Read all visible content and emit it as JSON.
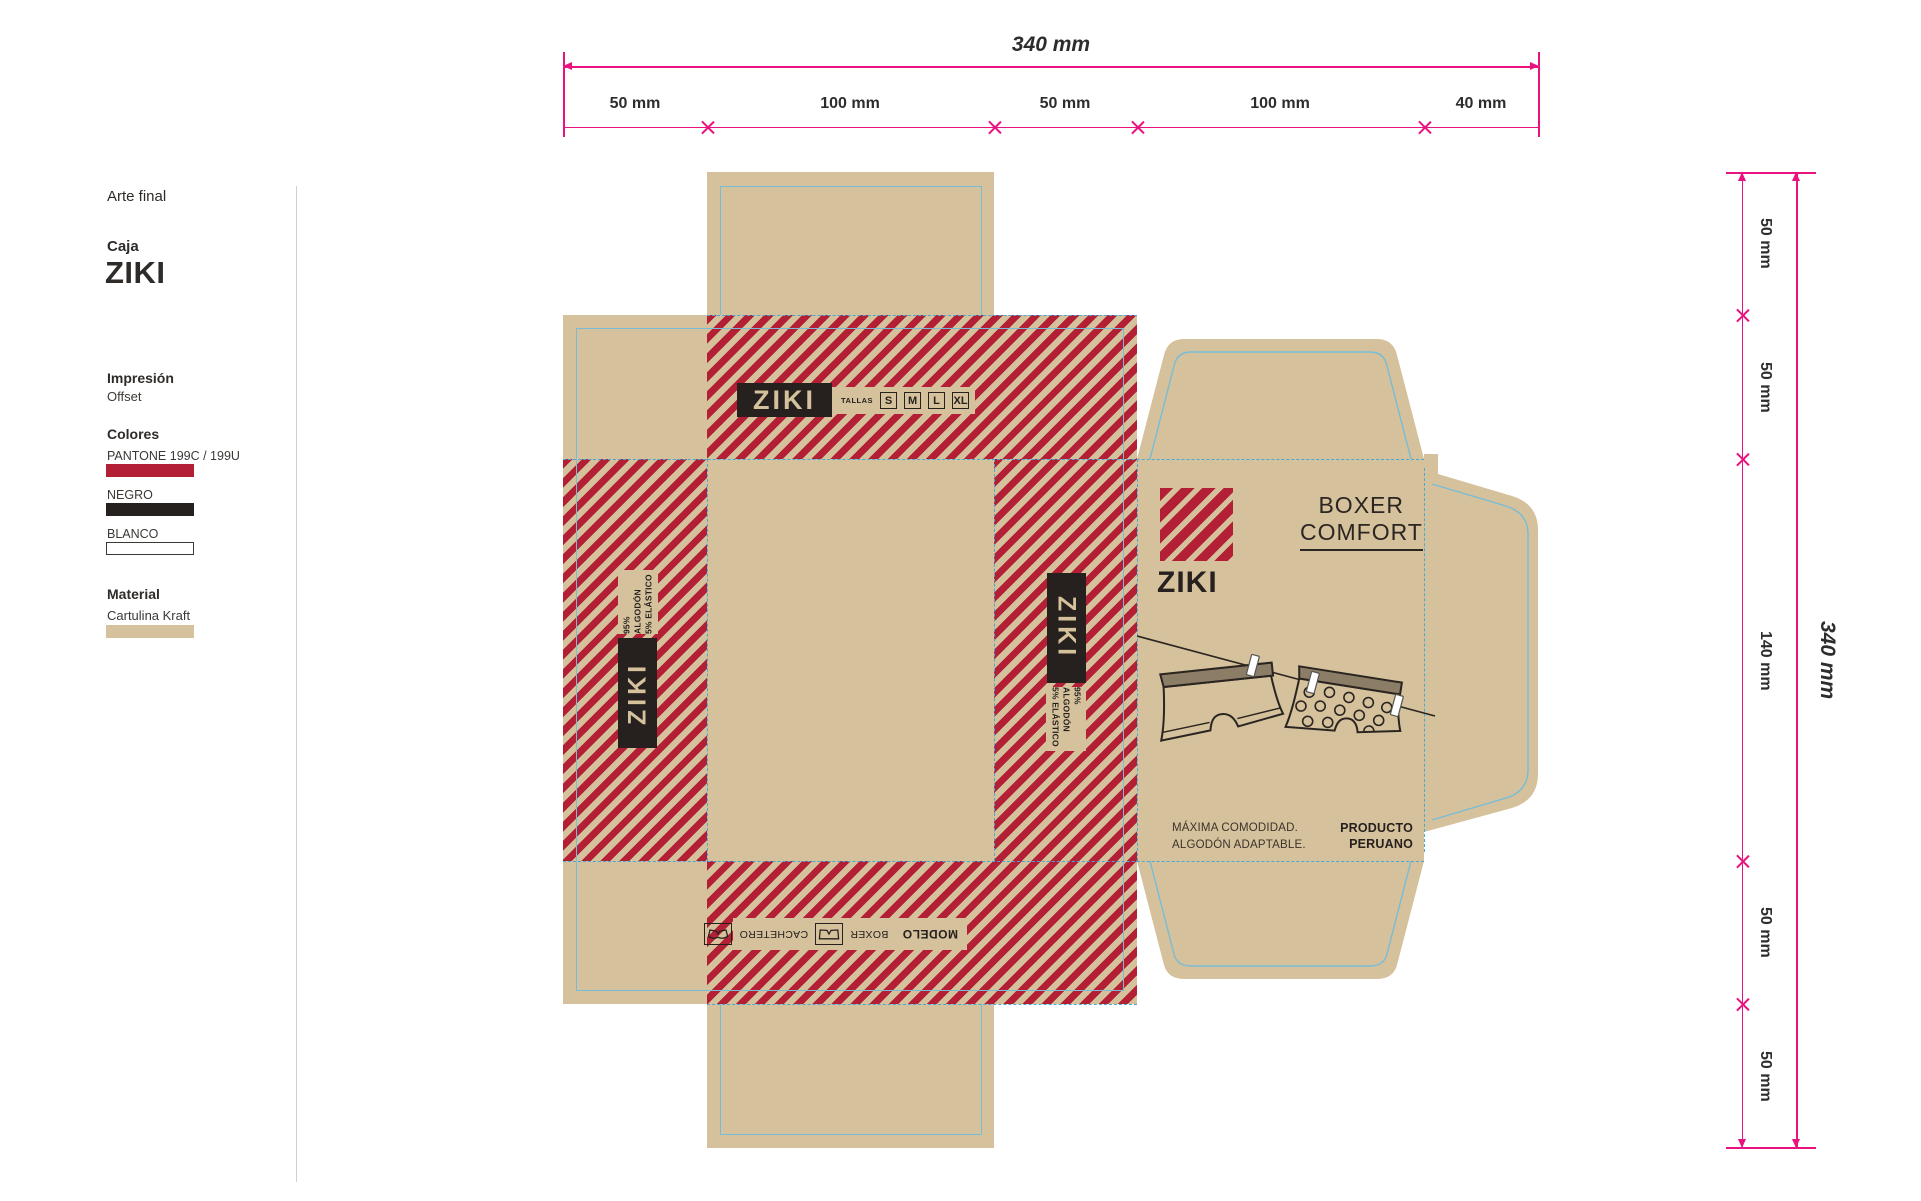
{
  "sidebar": {
    "title": "Arte final",
    "project_label": "Caja",
    "project_name": "ZIKI",
    "print_label": "Impresión",
    "print_value": "Offset",
    "colors_label": "Colores",
    "colors": [
      {
        "name": "PANTONE 199C / 199U",
        "hex": "#b31f35"
      },
      {
        "name": "NEGRO",
        "hex": "#26211f"
      },
      {
        "name": "BLANCO",
        "hex": "#ffffff"
      }
    ],
    "material_label": "Material",
    "material_name": "Cartulina Kraft",
    "material_hex": "#d5c19b"
  },
  "dimensions": {
    "top": {
      "total": "340 mm",
      "segments": [
        "50 mm",
        "100 mm",
        "50 mm",
        "100 mm",
        "40 mm"
      ]
    },
    "right": {
      "total": "340 mm",
      "segments": [
        "50 mm",
        "50 mm",
        "140 mm",
        "50 mm",
        "50 mm"
      ]
    }
  },
  "dieline": {
    "top_band": {
      "brand": "ZIKI",
      "sizes_label": "TALLAS",
      "sizes": [
        "S",
        "M",
        "L",
        "XL"
      ]
    },
    "side_band": {
      "brand": "ZIKI",
      "composition": [
        "95% ALGODÓN",
        "5% ELÁSTICO"
      ]
    },
    "bottom_band": {
      "model_label": "MODELO",
      "options": [
        "BOXER",
        "CACHETERO"
      ]
    },
    "front": {
      "brand": "ZIKI",
      "product": [
        "BOXER",
        "COMFORT"
      ],
      "tagline": [
        "MÁXIMA COMODIDAD.",
        "ALGODÓN ADAPTABLE."
      ],
      "origin": [
        "PRODUCTO",
        "PERUANO"
      ]
    }
  },
  "palette": {
    "kraft": "#d5c19b",
    "red": "#b31f35",
    "black": "#26211f",
    "fold_blue": "#58b2d8",
    "dimension_pink": "#e8137f"
  }
}
